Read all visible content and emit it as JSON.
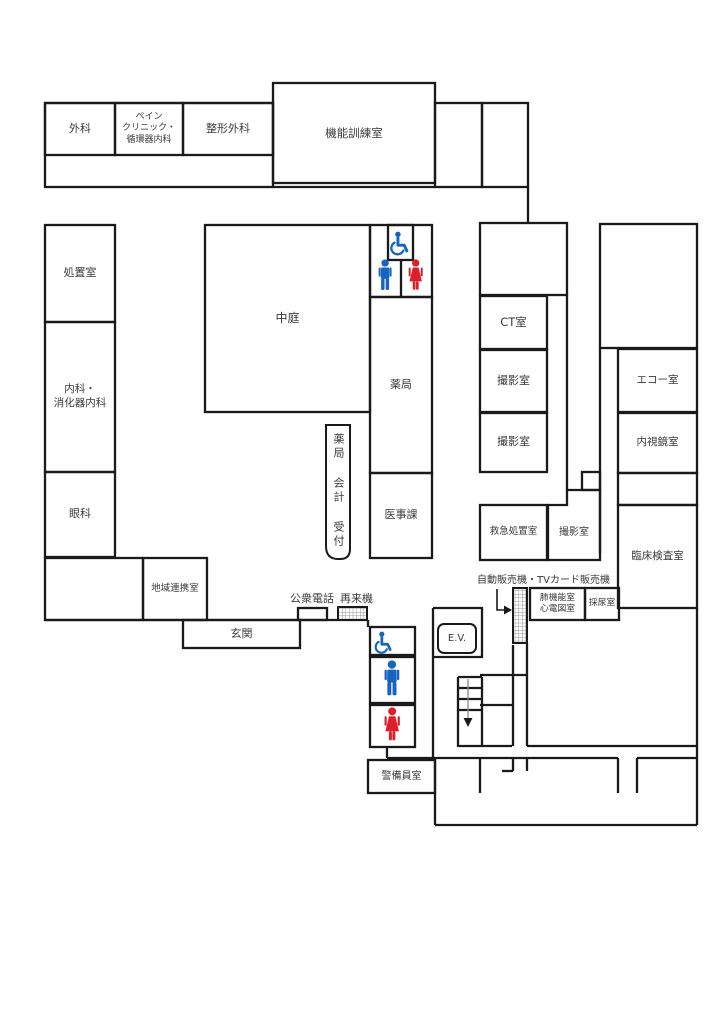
{
  "title": "hospital-floor-map",
  "rooms": {
    "surgery": "外科",
    "pain_clinic": "ペイン\nクリニック・\n循環器内科",
    "orthopedics": "整形外科",
    "function_training": "機能訓練室",
    "treatment": "処置室",
    "internal_medicine": "内科・\n消化器内科",
    "ophthalmology": "眼科",
    "regional_cooperation": "地域連携室",
    "entrance": "玄関",
    "courtyard": "中庭",
    "pharmacy": "薬局",
    "medical_affairs": "医事課",
    "counter": "薬局 会計 受付",
    "ct": "CT室",
    "imaging1": "撮影室",
    "imaging2": "撮影室",
    "emergency": "救急処置室",
    "imaging3": "撮影室",
    "echo": "エコー室",
    "endoscopy": "内視鏡室",
    "clinical_lab": "臨床検査室",
    "pulmonary_ecg": "肺機能室\n心電図室",
    "urine_room": "採尿室",
    "security": "警備員室"
  },
  "facilities": {
    "elevator": "E.V.",
    "public_phone": "公衆電話",
    "reception_machine": "再来機",
    "vending": "自動販売機・TVカード販売機"
  },
  "icons": {
    "accessible_toilet": "wheelchair",
    "male_toilet": "male-figure",
    "female_toilet": "female-figure",
    "stairs_down": "down-arrow"
  },
  "colors": {
    "wall": "#1a1a1a",
    "male": "#1565c0",
    "female": "#dd1f2b",
    "accessible": "#1565c0",
    "text": "#3a3a3a"
  }
}
